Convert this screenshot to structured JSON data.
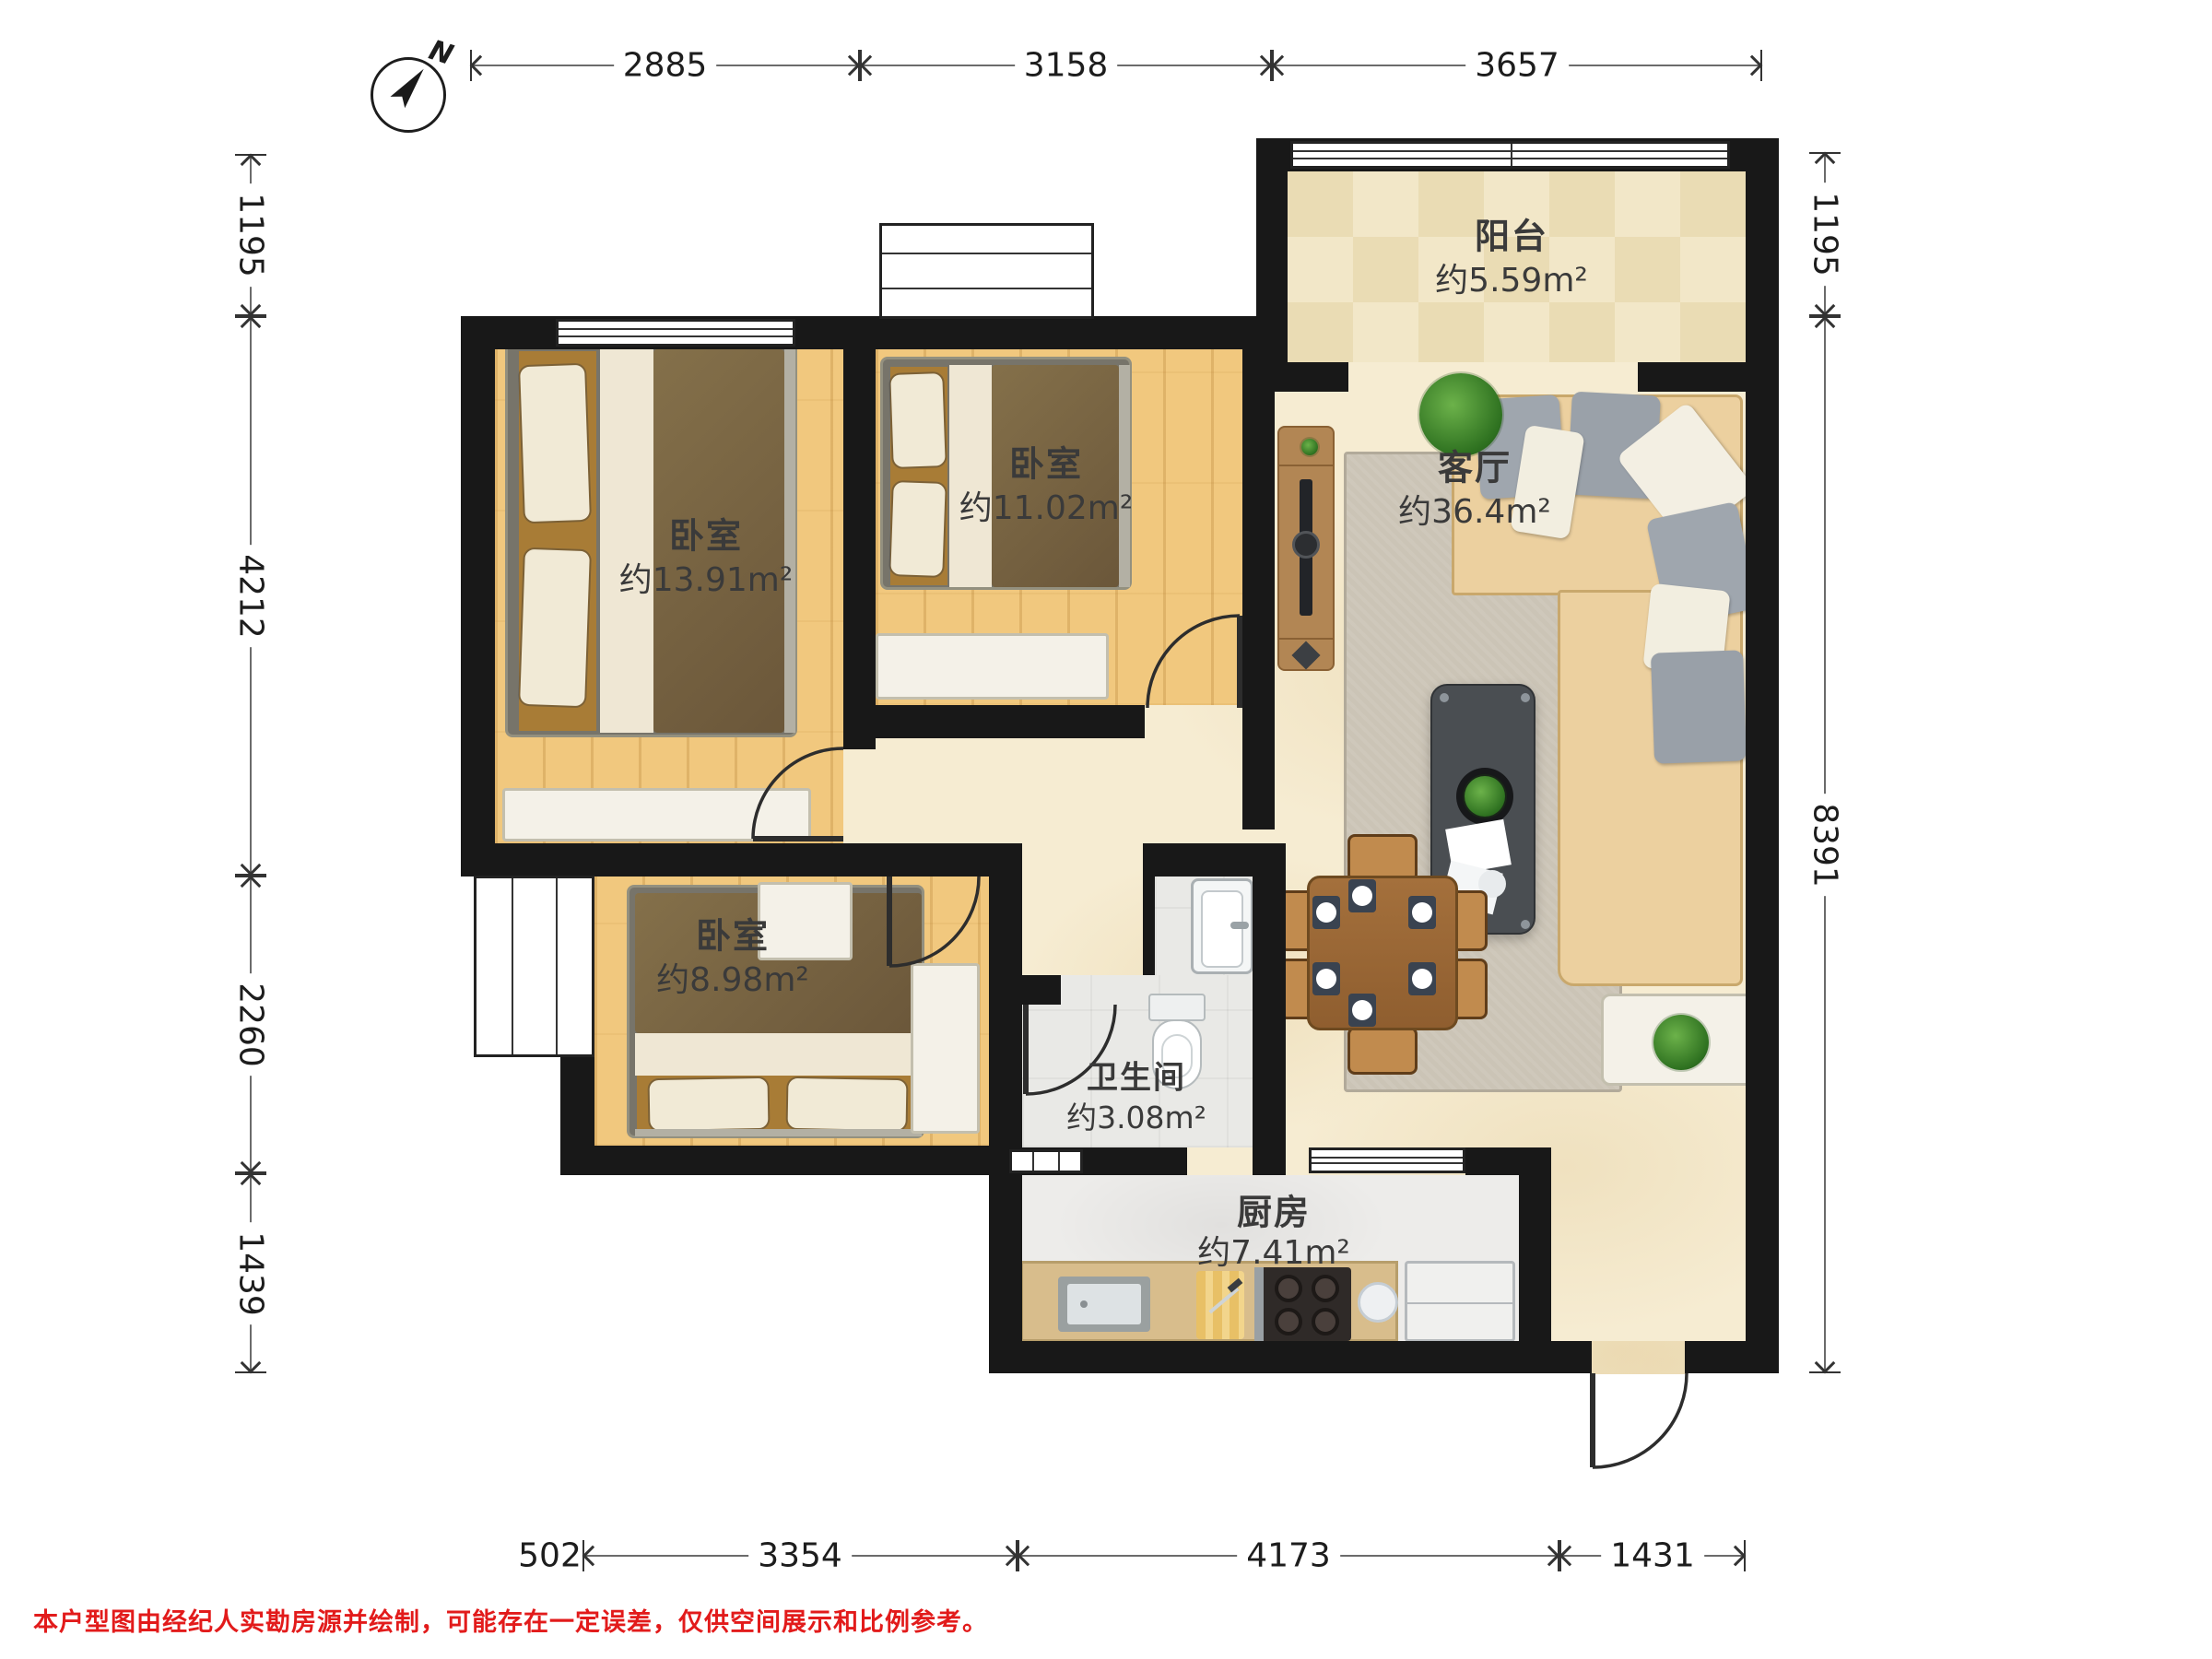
{
  "compass": {
    "north_label": "N"
  },
  "rooms": [
    {
      "id": "bedroom-master",
      "name": "卧室",
      "area": "约13.91m²"
    },
    {
      "id": "bedroom-second",
      "name": "卧室",
      "area": "约11.02m²"
    },
    {
      "id": "bedroom-third",
      "name": "卧室",
      "area": "约8.98m²"
    },
    {
      "id": "living-room",
      "name": "客厅",
      "area": "约36.4m²"
    },
    {
      "id": "balcony",
      "name": "阳台",
      "area": "约5.59m²"
    },
    {
      "id": "bathroom",
      "name": "卫生间",
      "area": "约3.08m²"
    },
    {
      "id": "kitchen",
      "name": "厨房",
      "area": "约7.41m²"
    }
  ],
  "dimensions": {
    "top": [
      "2885",
      "3158",
      "3657"
    ],
    "left": [
      "1195",
      "4212",
      "2260",
      "1439"
    ],
    "right": [
      "1195",
      "8391"
    ],
    "bottom": [
      "502",
      "3354",
      "4173",
      "1431"
    ]
  },
  "disclaimer": "本户型图由经纪人实勘房源并绘制，可能存在一定误差，仅供空间展示和比例参考。",
  "colors": {
    "wall": "#181818",
    "wood": "#f1c87e",
    "marble": "#f6ecd2",
    "tile-a": "#f2e7c8",
    "tile-b": "#eadcb4",
    "bath": "#e9e9e6",
    "kfloor": "#edecea",
    "counter": "#d8bd8c",
    "duvet": "#7d6742",
    "sofa": "#ecd09f",
    "twood": "#a06b38",
    "rug": "#cbc4b6",
    "red": "#e21b1b",
    "dim": "#333333",
    "label": "#3a3a3a"
  }
}
